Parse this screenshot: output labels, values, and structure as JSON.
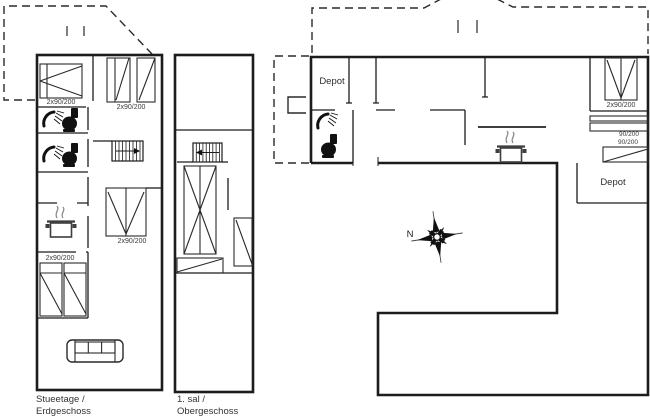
{
  "colors": {
    "background": "#ffffff",
    "line": "#1c1c1c",
    "text": "#2e2e2e"
  },
  "ground_floor": {
    "caption_line1": "Stueetage /",
    "caption_line2": "Erdgeschoss",
    "bed_label_top_left": "2x90/200",
    "bed_label_top_right": "2x90/200",
    "bed_label_middle": "2x90/200",
    "bed_label_bottom": "2x90/200"
  },
  "upper_floor": {
    "caption_line1": "1. sal /",
    "caption_line2": "Obergeschoss"
  },
  "overview_plan": {
    "depot_top_label": "Depot",
    "depot_side_label": "Depot",
    "bed_label": "2x90/200",
    "bunk_label_top": "90/200",
    "bunk_label_bottom": "90/200",
    "compass_label": "N"
  }
}
